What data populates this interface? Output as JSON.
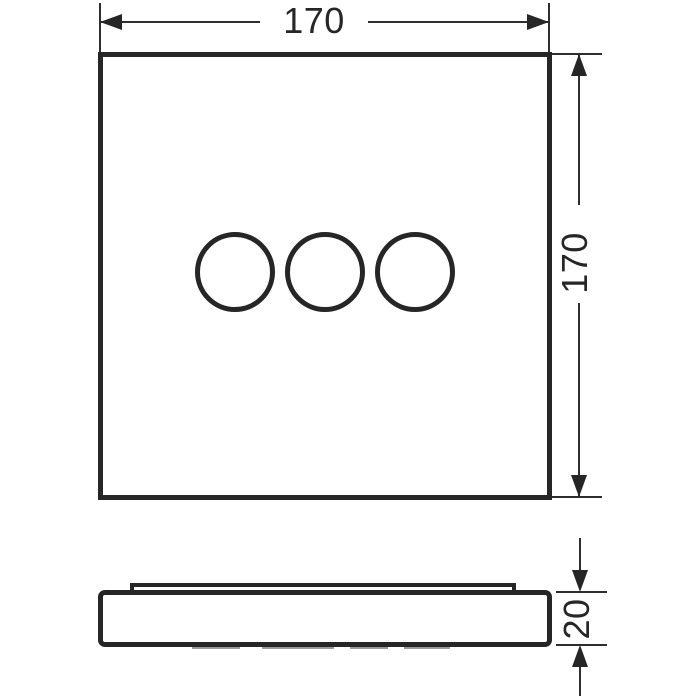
{
  "drawing": {
    "type": "technical-dimension-drawing",
    "line_color": "#262626",
    "background_color": "#ffffff",
    "views": {
      "front_view": {
        "shape": "square-plate",
        "controls": [
          "circle",
          "circle",
          "circle"
        ]
      },
      "side_view": {
        "shape": "flat-profile-with-top-lip"
      }
    },
    "dimensions": {
      "width": {
        "label": "170",
        "orientation": "horizontal",
        "applies_to": "front-view-width"
      },
      "height": {
        "label": "170",
        "orientation": "vertical",
        "applies_to": "front-view-height"
      },
      "depth": {
        "label": "20",
        "orientation": "vertical",
        "applies_to": "side-view-thickness"
      }
    }
  }
}
